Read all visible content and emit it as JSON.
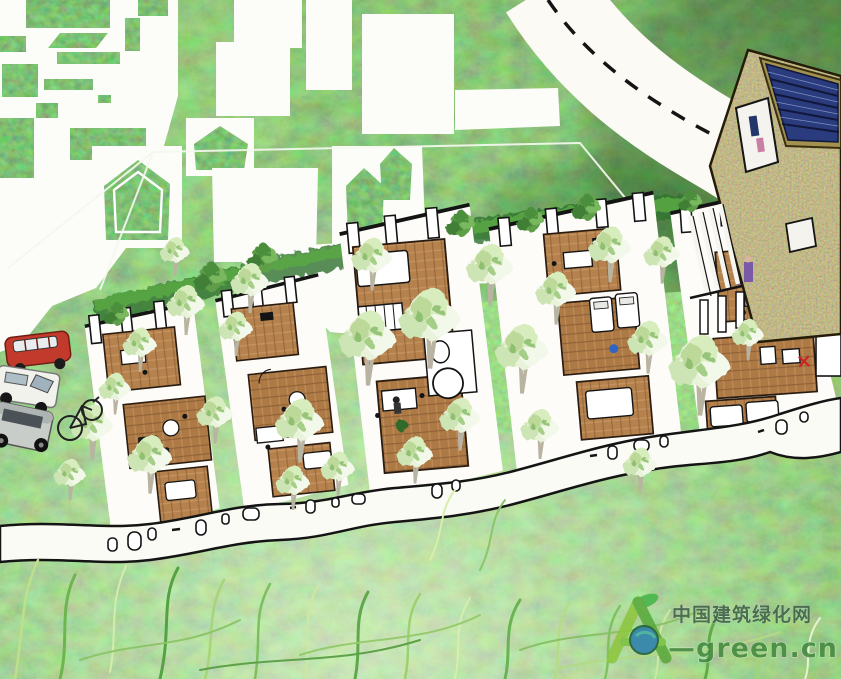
{
  "watermark": {
    "logo_icon": "leaf-a-logo",
    "site_name": "中国建筑绿化网",
    "site_url": "—green.cn"
  },
  "palette": {
    "vegetation_dark": "#2f7d33",
    "vegetation_mid": "#4f9e43",
    "vegetation_light": "#8fd36a",
    "paper_white": "#fbfbf5",
    "sketch_ink": "#141414",
    "wood_floor": "#b5824e",
    "solar_panel_blue": "#2b3c7e",
    "building_tan": "#8a7a45",
    "car_red": "#c23a2c",
    "van_white": "#f1f2ec",
    "suv_silver": "#c9cdc9",
    "logo_green": "#8dc63f",
    "logo_leaf": "#45b649",
    "logo_blue": "#2d7fae"
  }
}
